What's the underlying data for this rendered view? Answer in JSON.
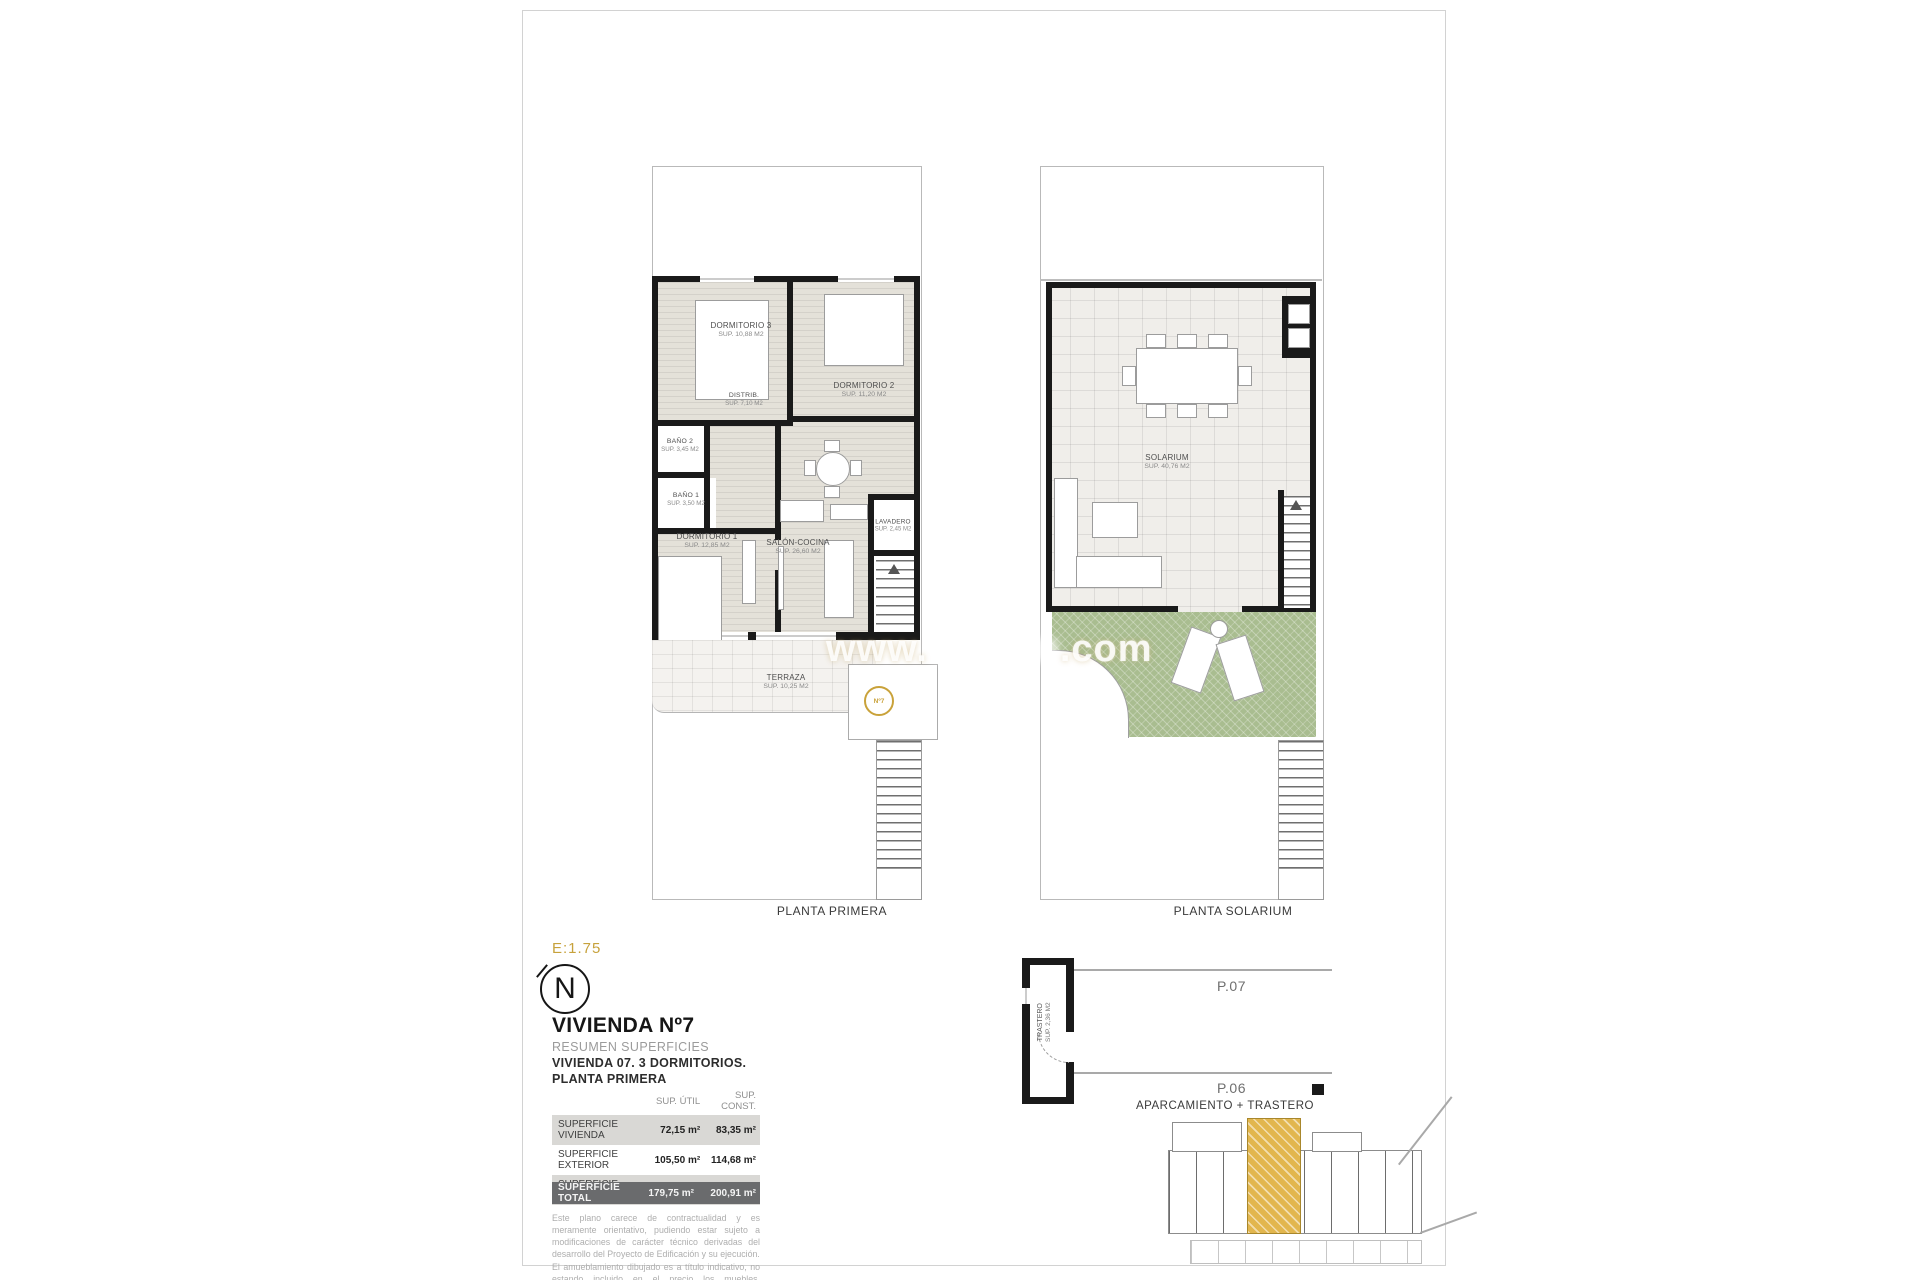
{
  "accent_gold": "#c7a23c",
  "legend": {
    "scale": "E:1.75",
    "north_letter": "N",
    "title": "VIVIENDA Nº7",
    "subtitle1": "RESUMEN SUPERFICIES",
    "subtitle2": "VIVIENDA 07. 3 DORMITORIOS.",
    "subtitle3": "PLANTA PRIMERA"
  },
  "table": {
    "col_util": "SUP. ÚTIL",
    "col_const": "SUP. CONST.",
    "rows": [
      {
        "label": "SUPERFICIE VIVIENDA",
        "util": "72,15 m²",
        "const": "83,35 m²"
      },
      {
        "label": "SUPERFICIE EXTERIOR",
        "util": "105,50 m²",
        "const": "114,68 m²"
      },
      {
        "label": "SUPERFICIE TRASTERO",
        "util": "2,10 m²",
        "const": "2,88 m²"
      }
    ],
    "total": {
      "label": "SUPERFICIE TOTAL",
      "util": "179,75 m²",
      "const": "200,91 m²"
    }
  },
  "disclaimer": {
    "p1": "Este plano carece de contractualidad y es meramente orientativo, pudiendo estar sujeto a modificaciones de carácter técnico derivadas del desarrollo del Proyecto de Edificación y su ejecución.",
    "p2": "El amueblamiento dibujado es a título indicativo, no estando incluido en el precio los muebles, electrodomésticos ni elementos de decoración.",
    "p3": "Solo se incluye los elementos incluidos en la memoria del Proyecto visado."
  },
  "plans": {
    "primera": {
      "caption": "PLANTA PRIMERA",
      "badge": "Nº7",
      "rooms": [
        {
          "name": "DORMITORIO 3",
          "sup": "SUP. 10,88 M2"
        },
        {
          "name": "DORMITORIO 2",
          "sup": "SUP. 11,20 M2"
        },
        {
          "name": "BAÑO 2",
          "sup": "SUP. 3,45 M2"
        },
        {
          "name": "DISTRIB.",
          "sup": "SUP. 7,10 M2"
        },
        {
          "name": "BAÑO 1",
          "sup": "SUP. 3,50 M2"
        },
        {
          "name": "DORMITORIO 1",
          "sup": "SUP. 12,85 M2"
        },
        {
          "name": "SALÓN-COCINA",
          "sup": "SUP. 26,60 M2"
        },
        {
          "name": "LAVADERO",
          "sup": "SUP. 2,45 M2"
        },
        {
          "name": "TERRAZA",
          "sup": "SUP. 10,25 M2"
        }
      ]
    },
    "solarium": {
      "caption": "PLANTA SOLARIUM",
      "rooms": [
        {
          "name": "SOLARIUM",
          "sup": "SUP. 40,76 M2"
        }
      ]
    }
  },
  "parking": {
    "caption": "APARCAMIENTO + TRASTERO",
    "trastero_label": "TRASTERO",
    "trastero_sup": "SUP. 2,36 M2",
    "p07": "P.07",
    "p06": "P.06"
  },
  "watermark": {
    "prefix": "www.",
    "suffix": ".com"
  }
}
